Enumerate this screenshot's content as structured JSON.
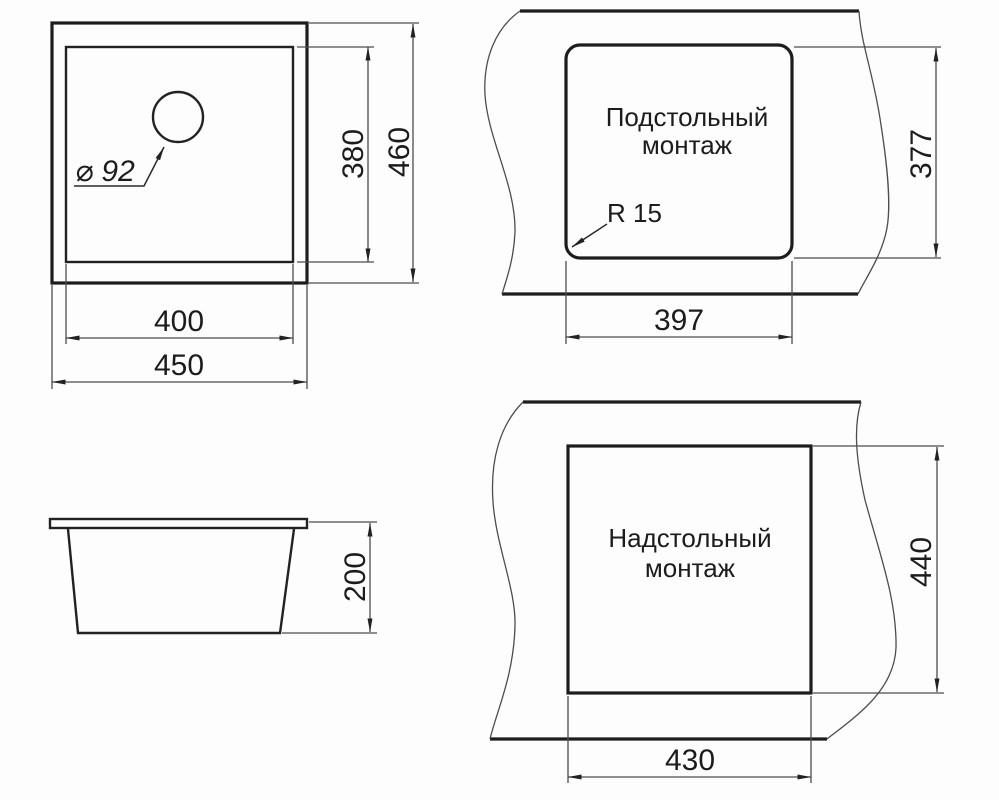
{
  "drawing": {
    "description": "Sink installation dimension drawing, four views",
    "colors": {
      "object_line": "#1d1d1d",
      "thin_line": "#4d4d4d",
      "text": "#1c1c1c",
      "background": "#fdfdfd"
    },
    "top_view": {
      "drain_label": "⌀ 92",
      "dim_inner_width": "400",
      "dim_outer_width": "450",
      "dim_inner_depth": "380",
      "dim_outer_depth": "460"
    },
    "side_view": {
      "dim_height": "200"
    },
    "undermount_view": {
      "title_line1": "Подстольный",
      "title_line2": "монтаж",
      "radius_label": "R 15",
      "dim_width": "397",
      "dim_depth": "377"
    },
    "overmount_view": {
      "title_line1": "Надстольный",
      "title_line2": "монтаж",
      "dim_width": "430",
      "dim_depth": "440"
    }
  }
}
